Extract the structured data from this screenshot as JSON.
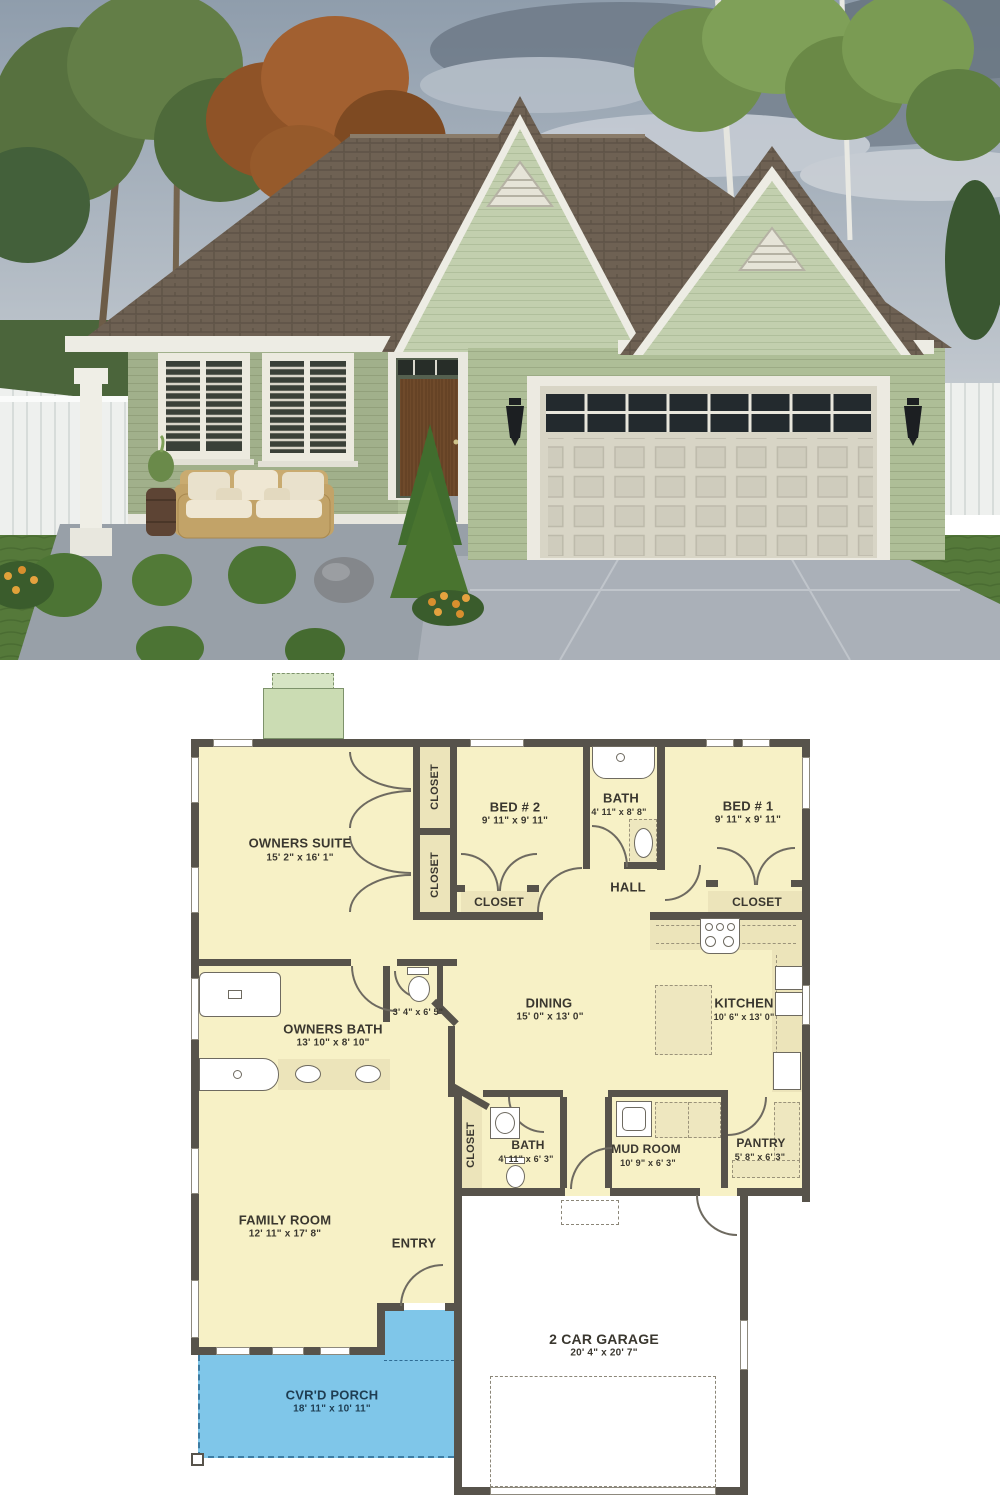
{
  "photo": {
    "scene": "rendered front exterior of a small green single-story house with two gables and a two-car garage",
    "colors": {
      "sky": "#9aa7b4",
      "cloud_dark": "#6e7a88",
      "roof": "#6e6153",
      "siding": "#aebe97",
      "gable_siding": "#c2cfae",
      "trim": "#edece4",
      "garage_door": "#d8d5c6",
      "front_door": "#6f4a2b",
      "lawn": "#55793a",
      "driveway": "#aab0b8",
      "porch_slab": "#98a0a8",
      "fence": "#eef0ee",
      "autumn_tree": "#a26030",
      "green_tree": "#5d7a45"
    }
  },
  "floor_plan": {
    "colors": {
      "wall": "#57534b",
      "room_fill": "#f7f1c6",
      "closet_fill": "#ece4ba",
      "porch_blue": "#7fc6e9",
      "patio_green": "#cbdcb3",
      "garage_fill": "#ffffff",
      "label_text": "#3a372f"
    },
    "rooms": {
      "owners_suite": {
        "name": "OWNERS SUITE",
        "dims": "15' 2\" x 16' 1\""
      },
      "closet_col_top": {
        "name": "CLOSET"
      },
      "closet_col_bottom": {
        "name": "CLOSET"
      },
      "bed2": {
        "name": "BED # 2",
        "dims": "9' 11\" x 9' 11\""
      },
      "bath_top": {
        "name": "BATH",
        "dims": "4' 11\" x 8' 8\""
      },
      "bed1": {
        "name": "BED # 1",
        "dims": "9' 11\" x 9' 11\""
      },
      "hall": {
        "name": "HALL"
      },
      "closet_bed2": {
        "name": "CLOSET"
      },
      "closet_bed1": {
        "name": "CLOSET"
      },
      "owners_bath": {
        "name": "OWNERS BATH",
        "dims": "13' 10\" x 8' 10\""
      },
      "water_closet": {
        "dims": "3' 4\" x 6' 5\""
      },
      "dining": {
        "name": "DINING",
        "dims": "15' 0\" x 13' 0\""
      },
      "kitchen": {
        "name": "KITCHEN",
        "dims": "10' 6\" x 13' 0\""
      },
      "closet_hall": {
        "name": "CLOSET"
      },
      "bath2": {
        "name": "BATH",
        "dims": "4' 11\" x 6' 3\""
      },
      "mud_room": {
        "name": "MUD ROOM",
        "dims": "10' 9\" x 6' 3\""
      },
      "pantry": {
        "name": "PANTRY",
        "dims": "5' 8\" x 6' 3\""
      },
      "family_room": {
        "name": "FAMILY ROOM",
        "dims": "12' 11\" x 17' 8\""
      },
      "entry": {
        "name": "ENTRY"
      },
      "porch": {
        "name": "CVR'D PORCH",
        "dims": "18' 11\" x 10' 11\""
      },
      "garage": {
        "name": "2 CAR GARAGE",
        "dims": "20' 4\" x 20' 7\""
      }
    }
  }
}
